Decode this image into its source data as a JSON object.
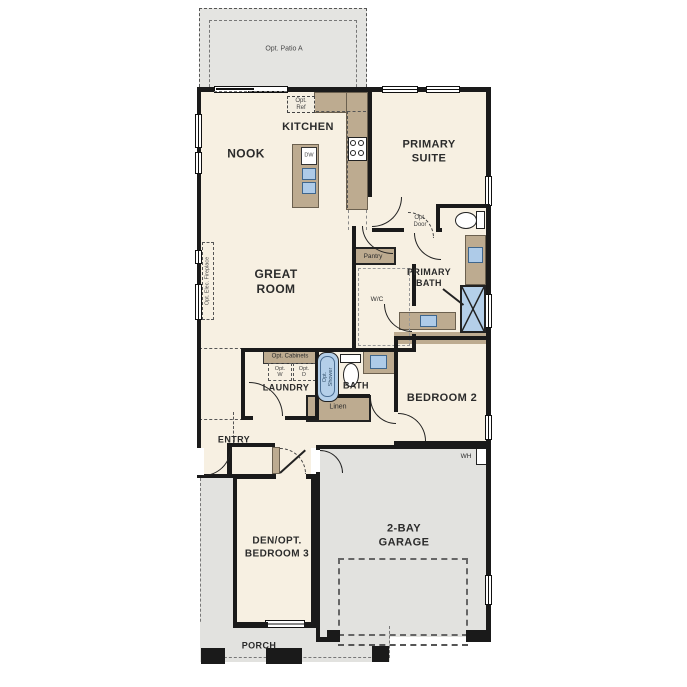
{
  "plan_title": "Single-story floor plan",
  "colors": {
    "wall": "#1a1a1a",
    "interior": "#f7f0e2",
    "exterior_concrete": "#e3e3e0",
    "cabinetry": "#bdab90",
    "plumbing_fixture": "#b4cfe9"
  },
  "labels": {
    "patio": "Opt. Patio A",
    "opt_ref": "Opt.\nRef",
    "kitchen": "KITCHEN",
    "nook": "NOOK",
    "dw": "DW",
    "primary_suite": "PRIMARY\nSUITE",
    "opt_door": "Opt.\nDoor",
    "pantry": "Pantry",
    "wc": "W/C",
    "primary_bath": "PRIMARY\nBATH",
    "great_room": "GREAT\nROOM",
    "opt_elec_fireplace": "Opt. Elec. Fireplace",
    "opt_cabinets": "Opt. Cabinets",
    "opt_w": "Opt.\nW",
    "opt_d": "Opt.\nD",
    "laundry": "LAUNDRY",
    "opt_shower": "Opt.\nShower",
    "bath": "BATH",
    "linen": "Linen",
    "bedroom2": "BEDROOM 2",
    "wh": "WH",
    "entry": "ENTRY",
    "den": "DEN/OPT.\nBEDROOM 3",
    "garage": "2-BAY\nGARAGE",
    "porch": "PORCH"
  }
}
